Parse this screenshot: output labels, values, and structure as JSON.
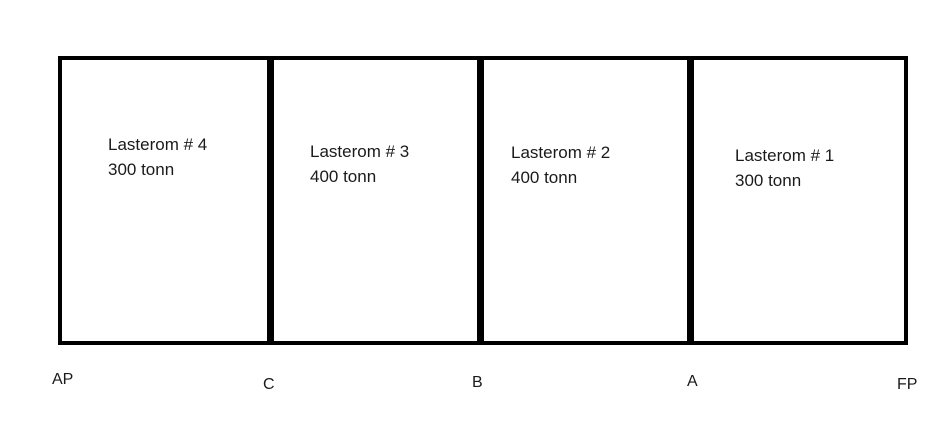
{
  "diagram": {
    "type": "ship-cargo-hold-layout",
    "colors": {
      "line": "#000000",
      "text": "#1a1a1a",
      "background": "#ffffff"
    },
    "compartments": [
      {
        "name": "Lasterom # 4",
        "load": "300 tonn"
      },
      {
        "name": "Lasterom # 3",
        "load": "400 tonn"
      },
      {
        "name": "Lasterom # 2",
        "load": "400 tonn"
      },
      {
        "name": "Lasterom # 1",
        "load": "300 tonn"
      }
    ],
    "markers": [
      {
        "label": "AP"
      },
      {
        "label": "C"
      },
      {
        "label": "B"
      },
      {
        "label": "A"
      },
      {
        "label": "FP"
      }
    ]
  }
}
